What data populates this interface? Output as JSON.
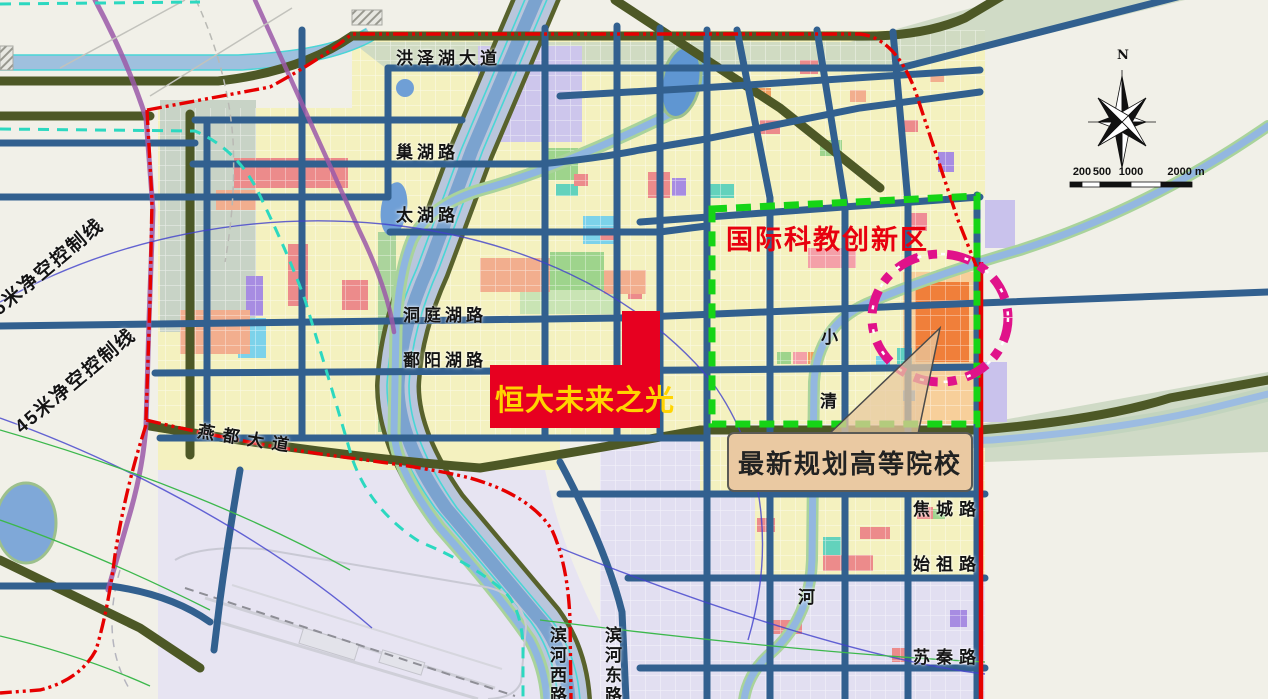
{
  "map": {
    "road_labels": {
      "hongzehu_avenue": "洪泽湖大道",
      "chaohu_road": "巢湖路",
      "taihu_road": "太湖路",
      "dongtinghu_road": "洞庭湖路",
      "poyanghu_road": "鄱阳湖路",
      "yandu_avenue": "燕都大道",
      "binhe_west_road": "滨河西路",
      "binhe_east_road": "滨河东路",
      "jiaocheng_road": "焦城路",
      "shizu_road": "始祖路",
      "suqin_road": "苏秦路"
    },
    "clearance_lines": {
      "line_05": "05米净空控制线",
      "line_45": "45米净空控制线"
    },
    "river_name_chars": {
      "xiao": "小",
      "qing": "清",
      "he": "河"
    },
    "highlights": {
      "hengda": {
        "label": "恒大未来之光",
        "text_color": "#ffd400",
        "fill": "#e70020"
      },
      "science_zone": {
        "label": "国际科教创新区",
        "text_color": "#e8000e",
        "border_color": "#16d416"
      },
      "colleges_callout": {
        "label": "最新规划高等院校",
        "bg": "#eac9a2",
        "text_color": "#222222"
      },
      "attention_circle_color": "#e0128a",
      "boundary_color": "#e60000"
    },
    "compass": {
      "north": "N"
    },
    "scale_bar": {
      "ticks": [
        "200",
        "500",
        "1000",
        "2000 m"
      ]
    }
  }
}
